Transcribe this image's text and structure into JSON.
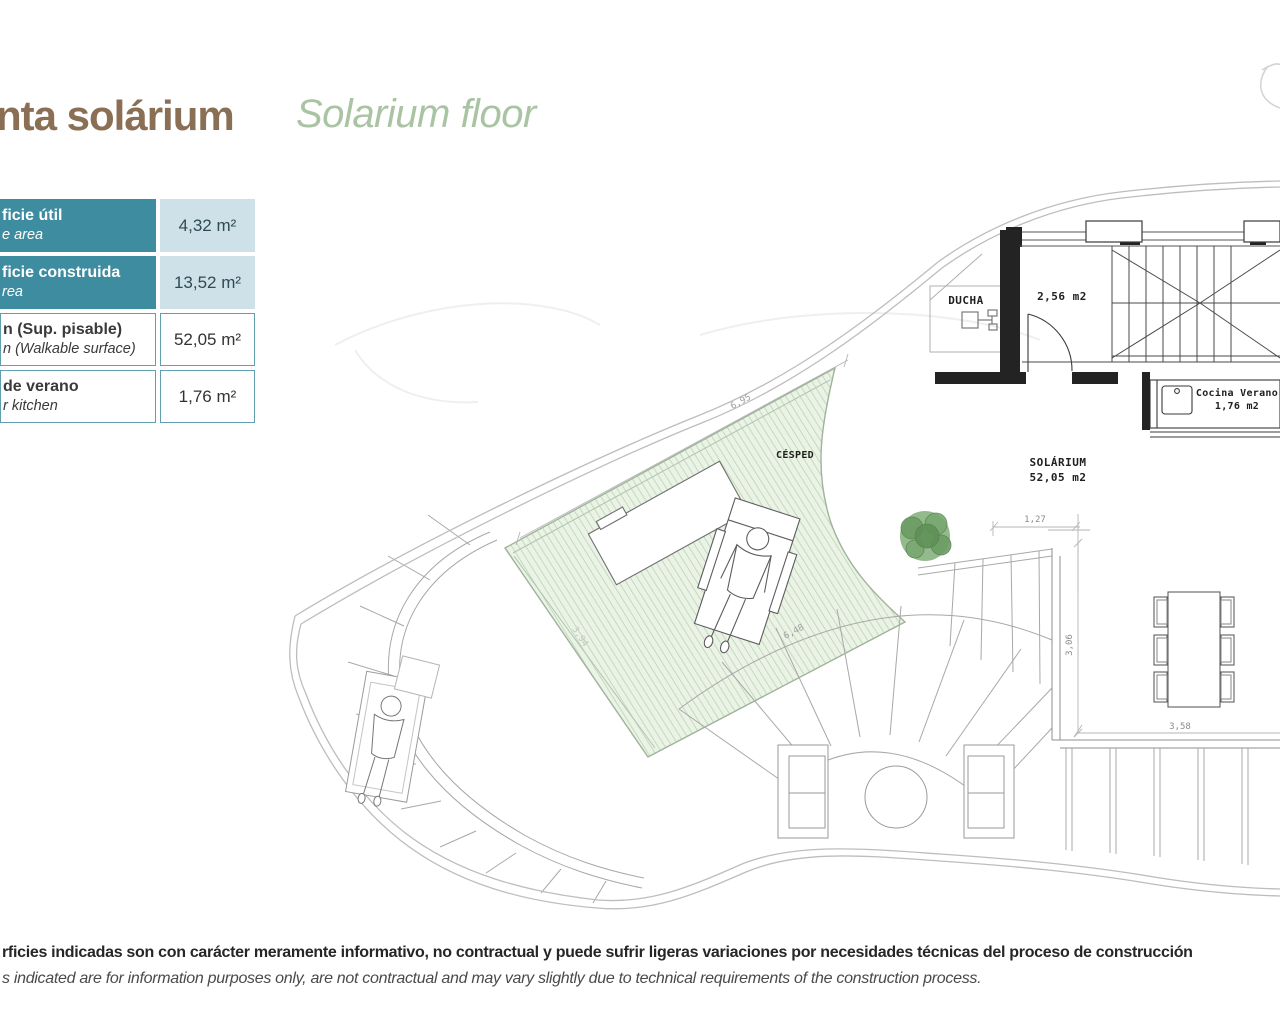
{
  "header": {
    "title_es": "nta solárium",
    "title_en": "Solarium floor"
  },
  "table": {
    "rows": [
      {
        "label_es": "ficie útil",
        "label_en": "e area",
        "value": "4,32 m²"
      },
      {
        "label_es": "ficie construida",
        "label_en": "rea",
        "value": "13,52 m²"
      },
      {
        "label_es": "n (Sup. pisable)",
        "label_en": "n (Walkable surface)",
        "value": "52,05 m²"
      },
      {
        "label_es": "de verano",
        "label_en": "r kitchen",
        "value": "1,76 m²"
      }
    ]
  },
  "plan": {
    "labels": {
      "ducha": "DUCHA",
      "room_area": "2,56 m2",
      "cocina_line1": "Cocina Verano",
      "cocina_line2": "1,76 m2",
      "cesped": "CÉSPED",
      "solarium_line1": "SOLÁRIUM",
      "solarium_line2": "52,05 m2",
      "dim_127": "1,27",
      "dim_306": "3,06",
      "dim_358": "3,58",
      "dim_695": "6,95",
      "dim_648": "6,48",
      "dim_394": "3,94"
    }
  },
  "footer": {
    "disclaimer_es": "rficies indicadas son con carácter meramente informativo, no contractual y puede sufrir ligeras variaciones por necesidades técnicas del proceso de construcción",
    "disclaimer_en": "s indicated are for information purposes only, are not contractual and may vary slightly due to technical requirements of the construction process."
  },
  "colors": {
    "teal": "#3e8ca0",
    "value-bg": "#cfe1e8",
    "title-brown": "#8a6f55",
    "title-green": "#a9c3a3",
    "grass-fill": "#eaf3e6",
    "grass-hatch": "#b7d2af"
  }
}
